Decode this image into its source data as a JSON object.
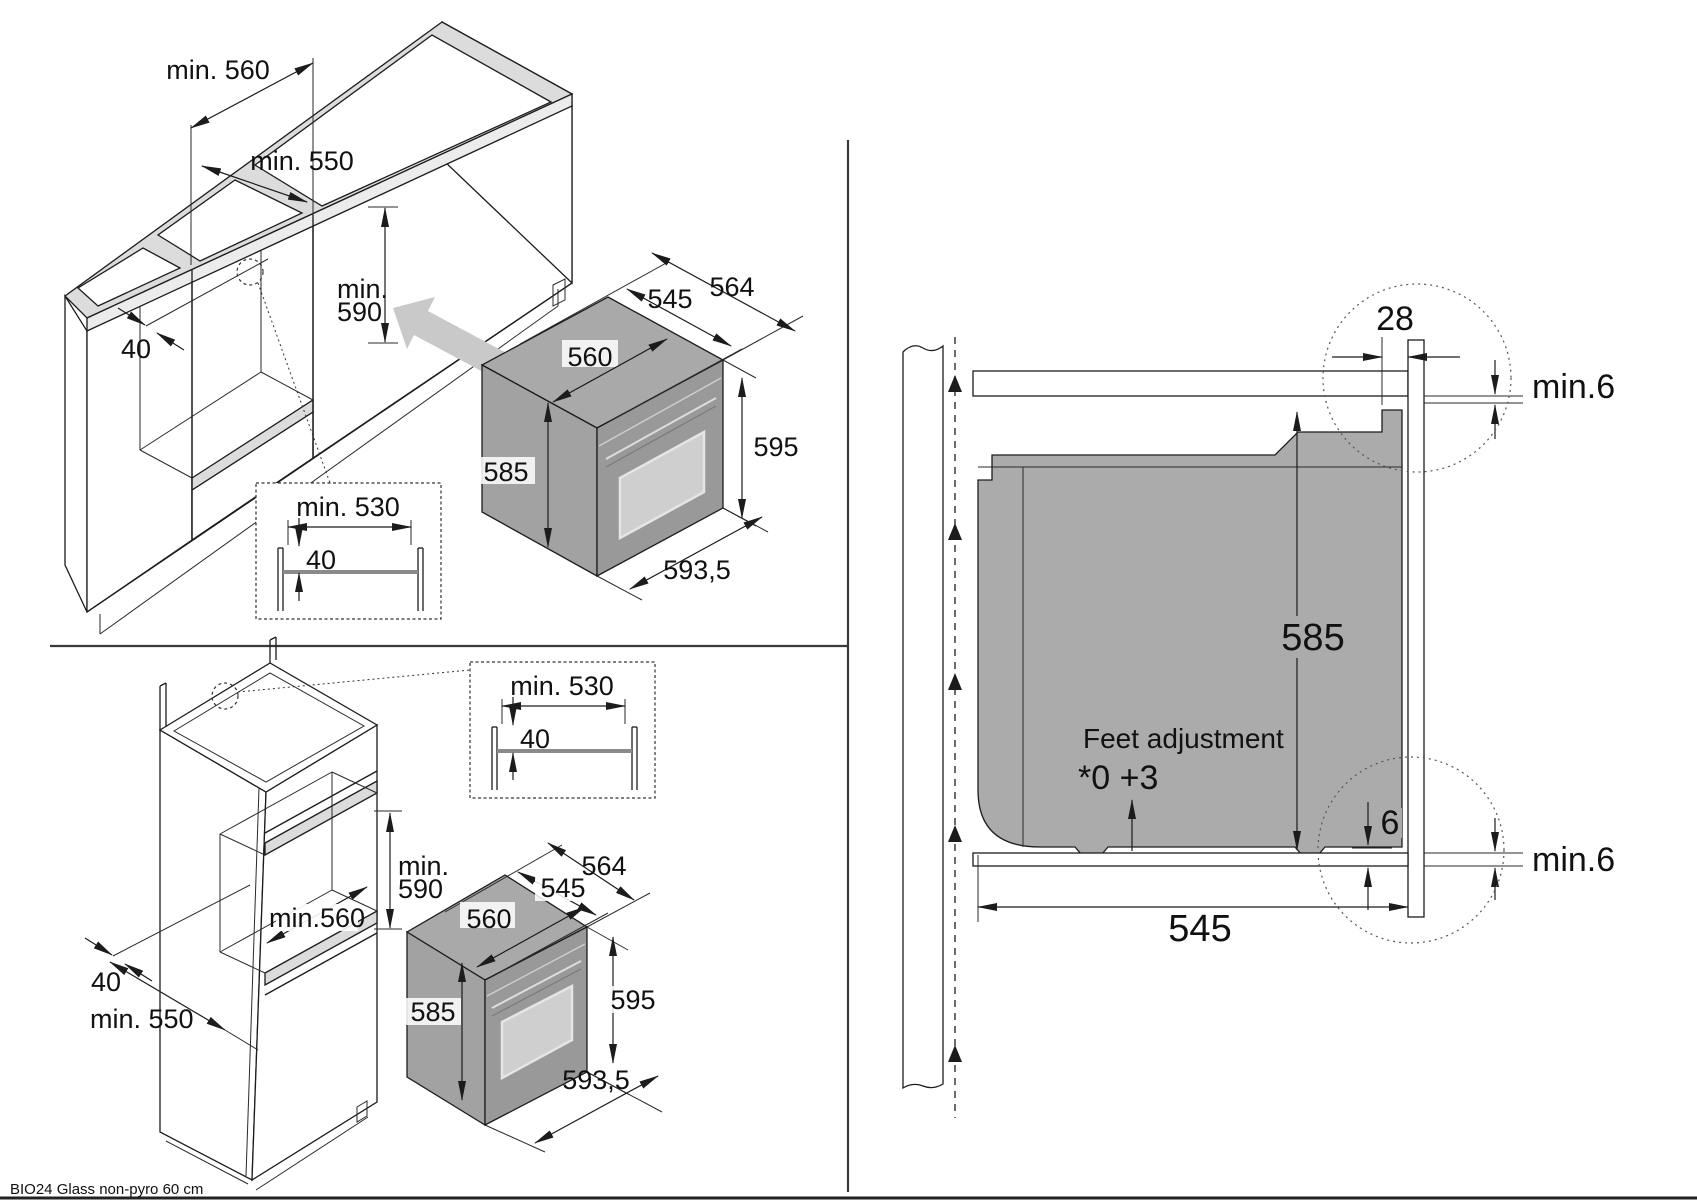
{
  "product_label": "BIO24 Glass non-pyro 60 cm",
  "undercounter": {
    "niche_width": "min. 560",
    "niche_depth": "min. 550",
    "niche_height_a": "min.",
    "niche_height_b": "590",
    "rail_inset": "40",
    "detail": {
      "width": "min. 530",
      "depth": "40"
    },
    "oven": {
      "depth_overall": "564",
      "depth_body": "545",
      "width_body": "560",
      "height_body": "585",
      "height_overall": "595",
      "width_overall": "593,5"
    }
  },
  "tall_unit": {
    "niche_height_a": "min.",
    "niche_height_b": "590",
    "niche_width": "min.560",
    "rail_inset": "40",
    "niche_depth": "min. 550",
    "detail": {
      "width": "min. 530",
      "depth": "40"
    },
    "oven": {
      "depth_overall": "564",
      "depth_body": "545",
      "width_body": "560",
      "height_body": "585",
      "height_overall": "595",
      "width_overall": "593,5"
    }
  },
  "cross_section": {
    "front_frame_depth": "28",
    "top_clearance": "min.6",
    "body_height": "585",
    "feet_note_line1": "Feet adjustment",
    "feet_note_line2": "*0 +3",
    "frame_overhang": "6",
    "bottom_clearance": "min.6",
    "body_depth": "545"
  }
}
